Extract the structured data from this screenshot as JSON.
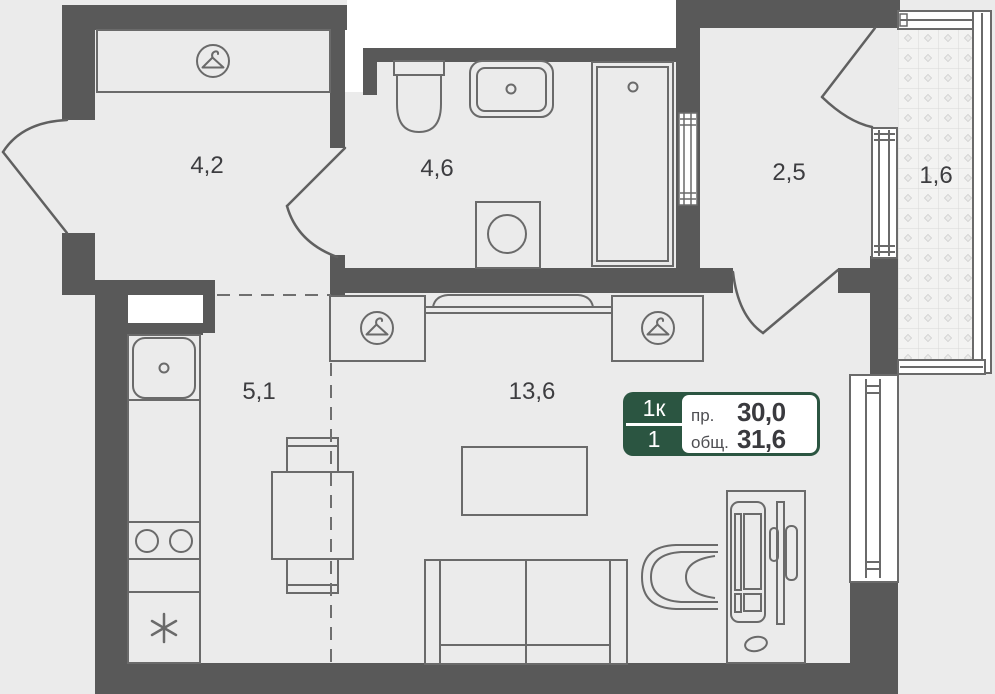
{
  "plan_type": "apartment-floor-plan",
  "rooms": [
    {
      "name": "entrance-hall",
      "area": "4,2"
    },
    {
      "name": "bathroom",
      "area": "4,6"
    },
    {
      "name": "hallway",
      "area": "2,5"
    },
    {
      "name": "balcony",
      "area": "1,6"
    },
    {
      "name": "kitchen-zone",
      "area": "5,1"
    },
    {
      "name": "living-zone",
      "area": "13,6"
    }
  ],
  "badge": {
    "rooms_label": "1к",
    "variant_label": "1",
    "projected_label": "пр.",
    "projected_value": "30,0",
    "total_label": "общ.",
    "total_value": "31,6"
  },
  "icons": {
    "wardrobe": "hanger-icon",
    "fridge": "snowflake-asterisk-icon",
    "stove": "two-burners-icon",
    "sink_drain": "drain-dot-icon"
  },
  "colors": {
    "wall": "#595959",
    "outline": "#6a6a6a",
    "floor": "#ebebeb",
    "void_white": "#ffffff",
    "badge_green": "#2b5541",
    "label_text": "#3d3d40",
    "balcony_hatch": "#d8d8d8"
  }
}
